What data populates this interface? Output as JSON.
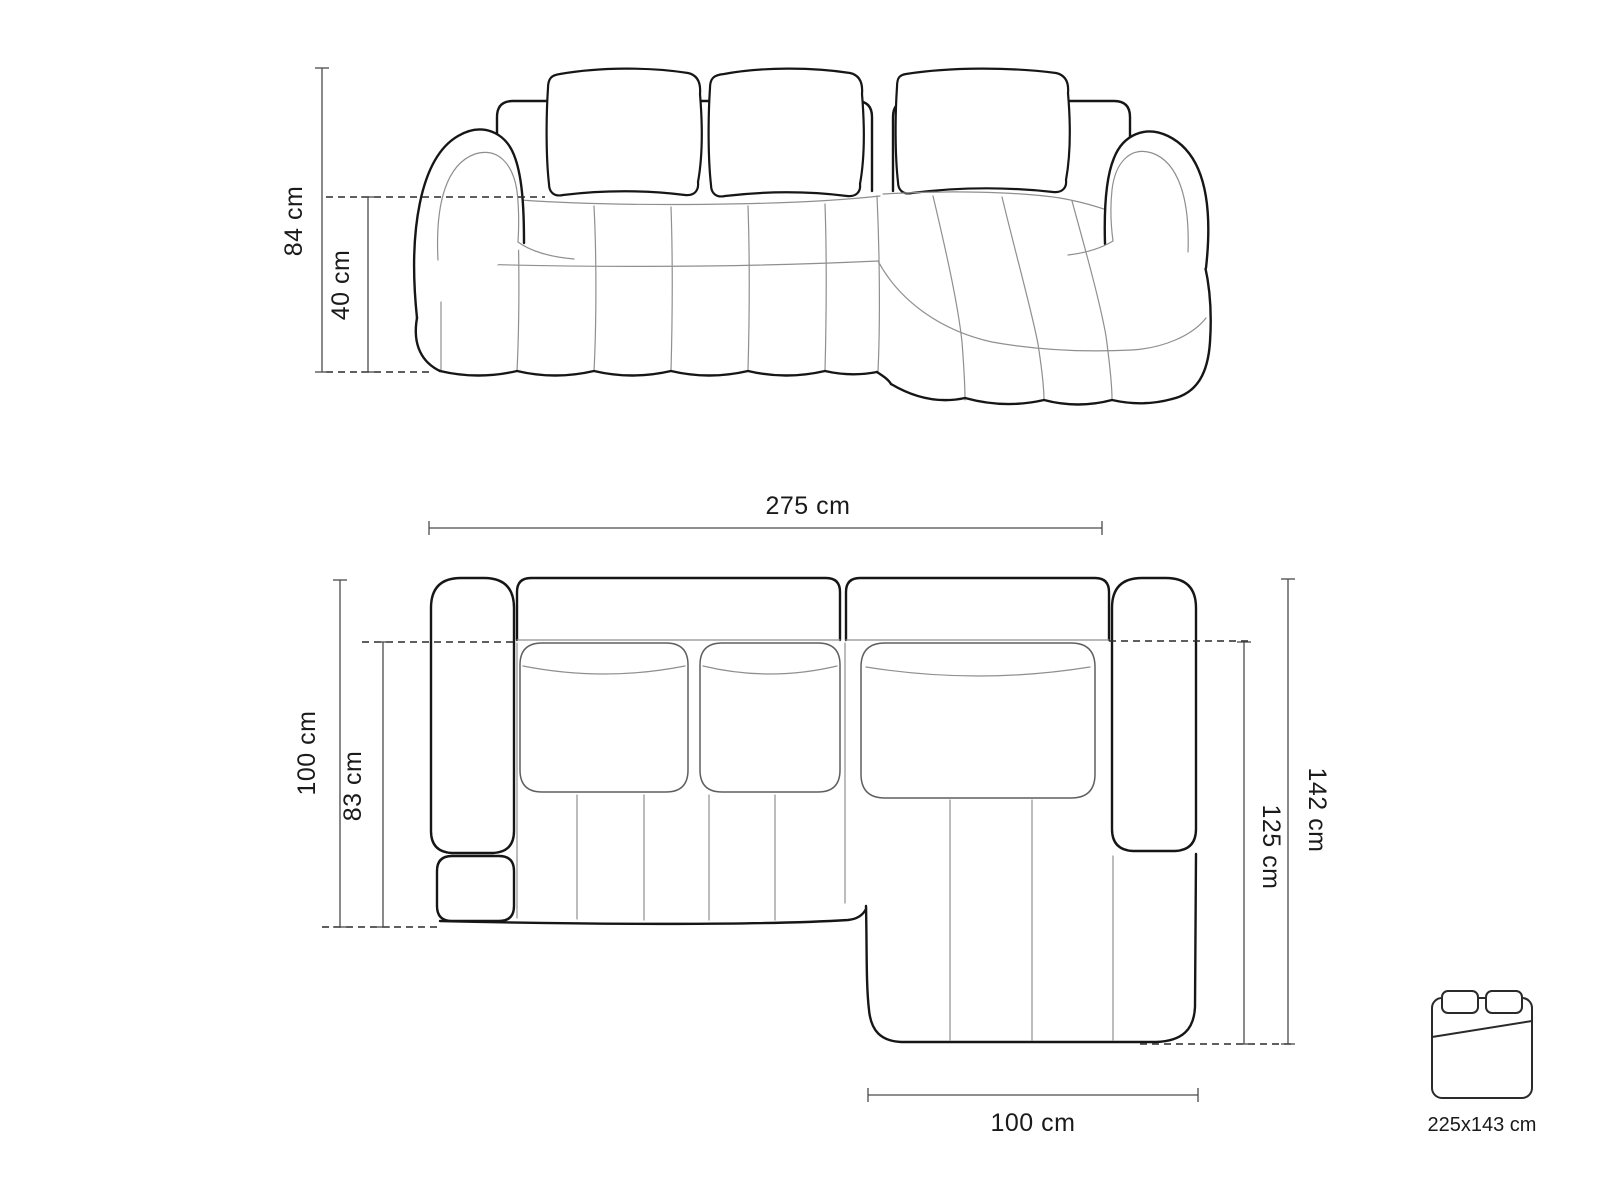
{
  "diagram": {
    "type": "sofa-dimension-drawing",
    "views": [
      "front-elevation",
      "top-plan"
    ],
    "colors": {
      "background": "#ffffff",
      "outline_bold": "#161616",
      "outline_thin": "#8f8f8f",
      "dimension_line": "#4a4a4a",
      "text": "#1a1a1a"
    }
  },
  "front_view": {
    "label_overall_height": "84 cm",
    "label_seat_height": "40 cm"
  },
  "top_view": {
    "label_overall_width": "275 cm",
    "label_body_depth": "100 cm",
    "label_seat_depth": "83 cm",
    "label_chaise_total_depth": "142 cm",
    "label_chaise_inner_depth": "125 cm",
    "label_chaise_width": "100 cm"
  },
  "sleeping_area": {
    "icon": "sofa-bed-icon",
    "label_size": "225x143 cm"
  }
}
